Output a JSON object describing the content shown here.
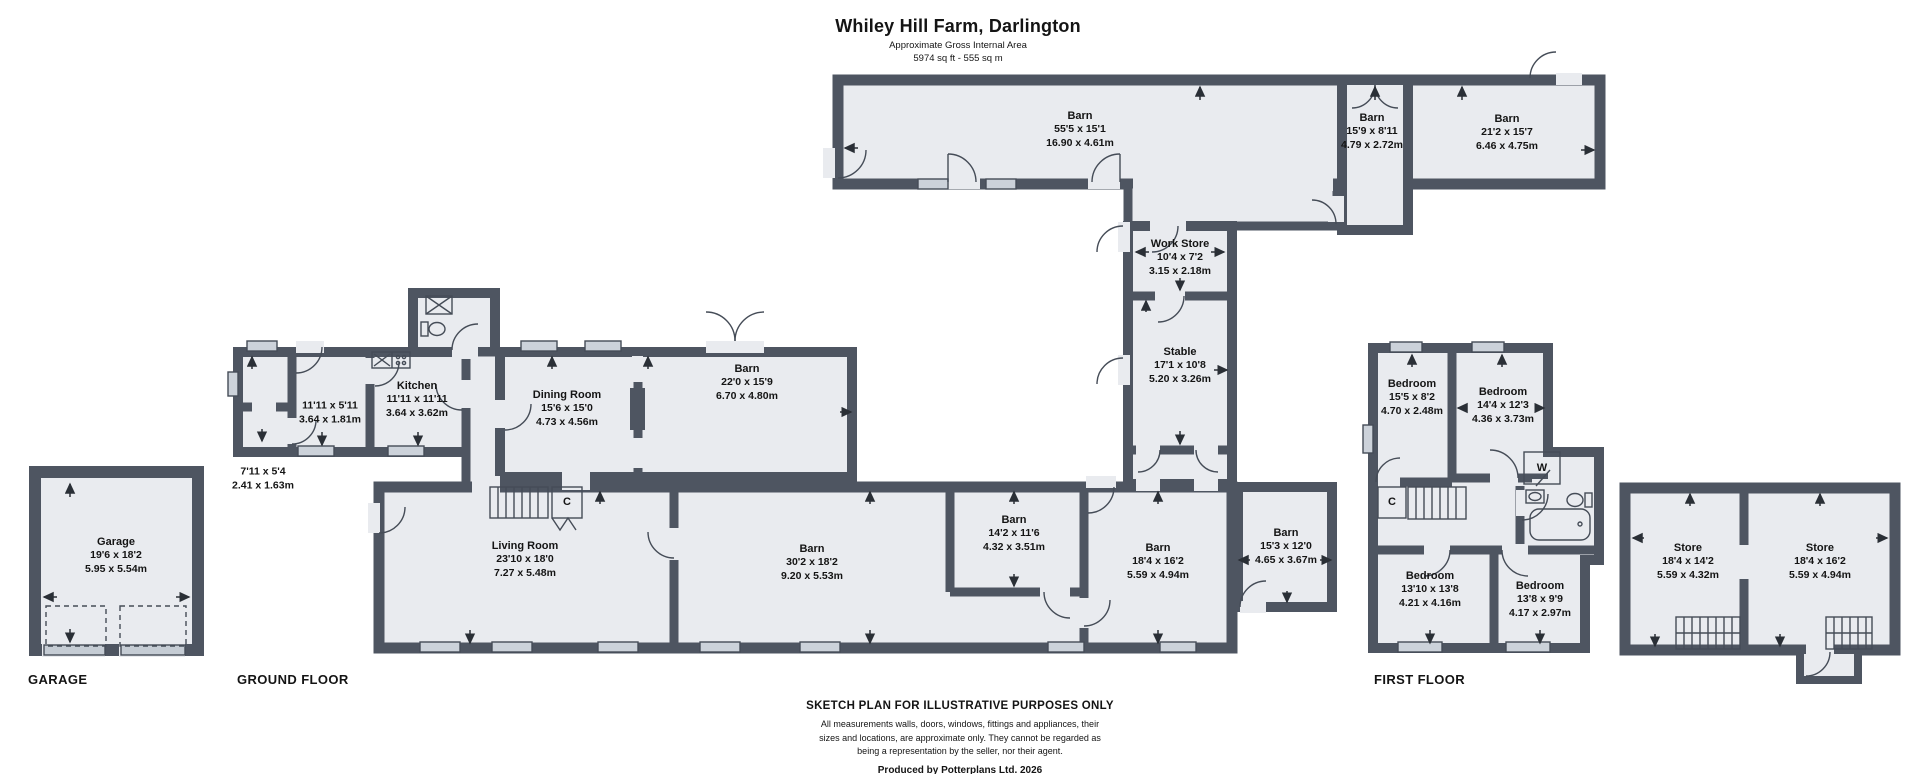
{
  "title": {
    "main": "Whiley Hill Farm, Darlington",
    "subtitle": "Approximate Gross Internal Area",
    "area": "5974 sq ft - 555 sq m"
  },
  "floor_labels": {
    "garage": "GARAGE",
    "ground": "GROUND FLOOR",
    "first": "FIRST FLOOR"
  },
  "footer": {
    "heading": "SKETCH PLAN FOR ILLUSTRATIVE PURPOSES ONLY",
    "disclaimer_lines": [
      "All measurements walls, doors, windows, fittings and appliances, their",
      "sizes and locations, are approximate only. They cannot be regarded as",
      "being a representation by the seller, nor their agent."
    ],
    "credit": "Produced by Potterplans Ltd. 2026"
  },
  "colors": {
    "wall": "#4e5561",
    "floor": "#e9ebef",
    "window": "#ccd2da",
    "text": "#141414"
  },
  "rooms": [
    {
      "name": "Barn",
      "ft": "55'5 x 15'1",
      "m": "16.90 x 4.61m",
      "x": 1080,
      "y": 130
    },
    {
      "name": "Barn",
      "ft": "15'9 x 8'11",
      "m": "4.79 x 2.72m",
      "x": 1372,
      "y": 132
    },
    {
      "name": "Barn",
      "ft": "21'2 x 15'7",
      "m": "6.46 x 4.75m",
      "x": 1507,
      "y": 133
    },
    {
      "name": "Work Store",
      "ft": "10'4 x 7'2",
      "m": "3.15 x 2.18m",
      "x": 1180,
      "y": 258
    },
    {
      "name": "Stable",
      "ft": "17'1 x 10'8",
      "m": "5.20 x 3.26m",
      "x": 1180,
      "y": 366
    },
    {
      "name": "Kitchen",
      "ft": "11'11 x 11'11",
      "m": "3.64 x 3.62m",
      "x": 417,
      "y": 400
    },
    {
      "name": "",
      "ft": "11'11 x 5'11",
      "m": "3.64 x 1.81m",
      "x": 330,
      "y": 413
    },
    {
      "name": "",
      "ft": "7'11 x 5'4",
      "m": "2.41 x 1.63m",
      "x": 263,
      "y": 479
    },
    {
      "name": "Dining Room",
      "ft": "15'6 x 15'0",
      "m": "4.73 x 4.56m",
      "x": 567,
      "y": 409
    },
    {
      "name": "Barn",
      "ft": "22'0 x 15'9",
      "m": "6.70 x 4.80m",
      "x": 747,
      "y": 383
    },
    {
      "name": "Garage",
      "ft": "19'6 x 18'2",
      "m": "5.95 x 5.54m",
      "x": 116,
      "y": 556
    },
    {
      "name": "Living Room",
      "ft": "23'10 x 18'0",
      "m": "7.27 x 5.48m",
      "x": 525,
      "y": 560
    },
    {
      "name": "Barn",
      "ft": "30'2 x 18'2",
      "m": "9.20 x 5.53m",
      "x": 812,
      "y": 563
    },
    {
      "name": "Barn",
      "ft": "14'2 x 11'6",
      "m": "4.32 x 3.51m",
      "x": 1014,
      "y": 534
    },
    {
      "name": "Barn",
      "ft": "18'4 x 16'2",
      "m": "5.59 x 4.94m",
      "x": 1158,
      "y": 562
    },
    {
      "name": "Barn",
      "ft": "15'3 x 12'0",
      "m": "4.65 x 3.67m",
      "x": 1286,
      "y": 547
    },
    {
      "name": "Bedroom",
      "ft": "15'5 x 8'2",
      "m": "4.70 x 2.48m",
      "x": 1412,
      "y": 398
    },
    {
      "name": "Bedroom",
      "ft": "14'4 x 12'3",
      "m": "4.36 x 3.73m",
      "x": 1503,
      "y": 406
    },
    {
      "name": "Bedroom",
      "ft": "13'10 x 13'8",
      "m": "4.21 x 4.16m",
      "x": 1430,
      "y": 590
    },
    {
      "name": "Bedroom",
      "ft": "13'8 x 9'9",
      "m": "4.17 x 2.97m",
      "x": 1540,
      "y": 600
    },
    {
      "name": "Store",
      "ft": "18'4 x 14'2",
      "m": "5.59 x 4.32m",
      "x": 1688,
      "y": 562
    },
    {
      "name": "Store",
      "ft": "18'4 x 16'2",
      "m": "5.59 x 4.94m",
      "x": 1820,
      "y": 562
    }
  ],
  "markers": [
    {
      "label": "C",
      "x": 567,
      "y": 502
    },
    {
      "label": "C",
      "x": 1392,
      "y": 502
    },
    {
      "label": "W",
      "x": 1542,
      "y": 468
    }
  ]
}
